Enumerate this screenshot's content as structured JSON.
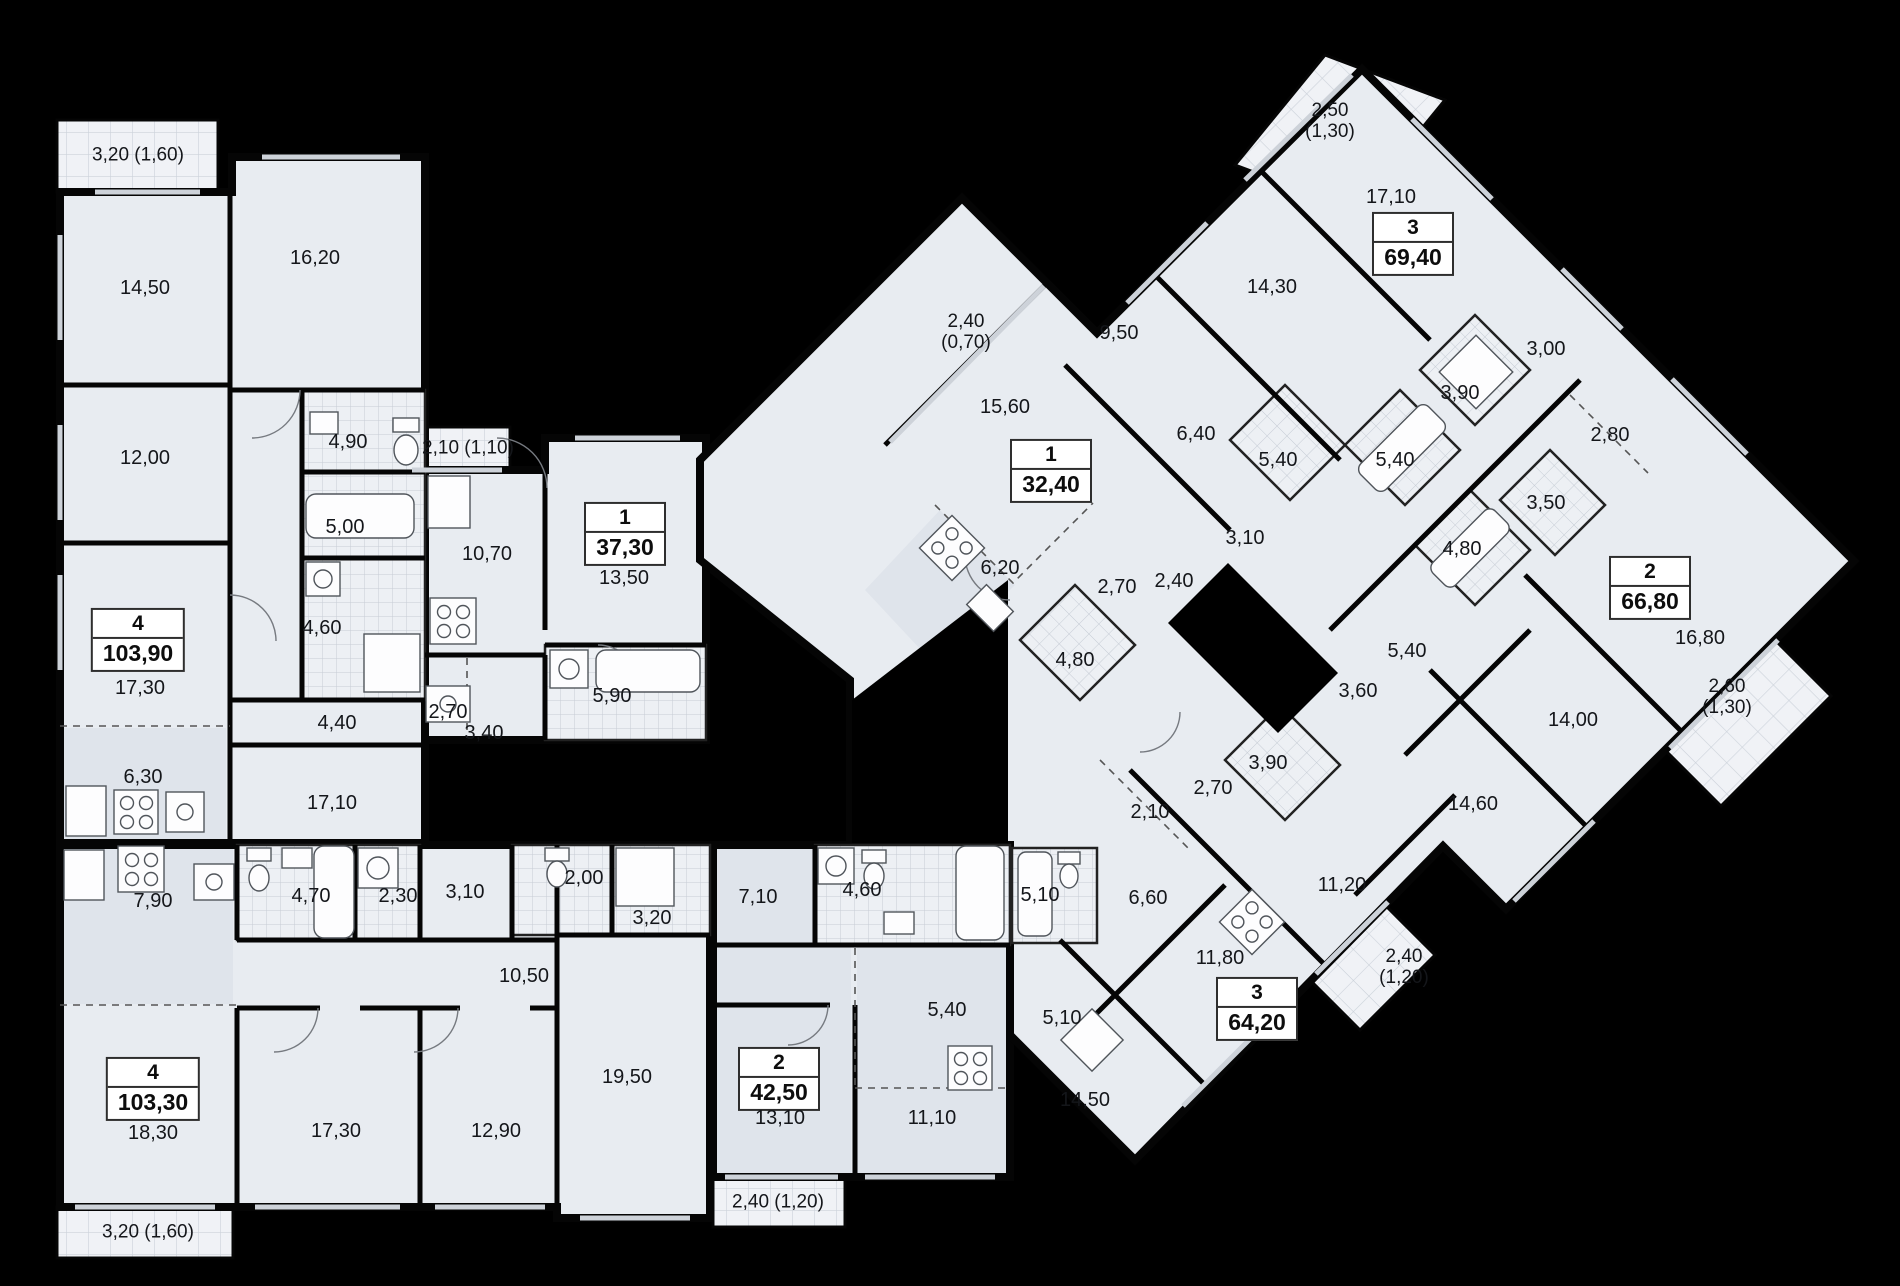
{
  "plan_type": "residential floor plan",
  "colors": {
    "background": "#000000",
    "walls": "#050505",
    "floor": "#e8ecf1",
    "floor_alt": "#dfe4eb",
    "tile_line": "#c6ccd5",
    "balcony_tile": "#f0f2f6",
    "text": "#14161a"
  },
  "apartments": [
    {
      "id": "apt-4-103-90",
      "rooms": "4",
      "area": "103,90",
      "badge": {
        "x": 138,
        "y": 640
      },
      "labels": [
        {
          "t": "14,50",
          "x": 145,
          "y": 288
        },
        {
          "t": "16,20",
          "x": 315,
          "y": 258
        },
        {
          "t": "12,00",
          "x": 145,
          "y": 458
        },
        {
          "t": "4,90",
          "x": 348,
          "y": 442
        },
        {
          "t": "5,00",
          "x": 345,
          "y": 527
        },
        {
          "t": "4,60",
          "x": 322,
          "y": 628
        },
        {
          "t": "17,30",
          "x": 140,
          "y": 688
        },
        {
          "t": "4,40",
          "x": 337,
          "y": 723
        },
        {
          "t": "6,30",
          "x": 143,
          "y": 777
        },
        {
          "t": "17,10",
          "x": 332,
          "y": 803
        }
      ],
      "balcony": {
        "lines": [
          "3,20 (1,60)"
        ],
        "x": 138,
        "y": 156
      }
    },
    {
      "id": "apt-1-37-30",
      "rooms": "1",
      "area": "37,30",
      "badge": {
        "x": 625,
        "y": 534
      },
      "labels": [
        {
          "t": "10,70",
          "x": 487,
          "y": 554
        },
        {
          "t": "13,50",
          "x": 624,
          "y": 578
        },
        {
          "t": "2,70",
          "x": 448,
          "y": 712
        },
        {
          "t": "3,40",
          "x": 484,
          "y": 733
        },
        {
          "t": "5,90",
          "x": 612,
          "y": 696
        }
      ],
      "balcony": {
        "lines": [
          "2,10 (1,10)"
        ],
        "x": 468,
        "y": 449
      }
    },
    {
      "id": "apt-1-32-40",
      "rooms": "1",
      "area": "32,40",
      "badge": {
        "x": 1051,
        "y": 471
      },
      "labels": [
        {
          "t": "15,60",
          "x": 1005,
          "y": 407
        },
        {
          "t": "6,20",
          "x": 1000,
          "y": 568
        },
        {
          "t": "2,70",
          "x": 1117,
          "y": 587
        },
        {
          "t": "2,40",
          "x": 1174,
          "y": 581
        },
        {
          "t": "4,80",
          "x": 1075,
          "y": 660
        }
      ],
      "balcony": {
        "lines": [
          "2,40",
          "(0,70)"
        ],
        "x": 966,
        "y": 333
      }
    },
    {
      "id": "apt-3-69-40",
      "rooms": "3",
      "area": "69,40",
      "badge": {
        "x": 1413,
        "y": 244
      },
      "labels": [
        {
          "t": "17,10",
          "x": 1391,
          "y": 197
        },
        {
          "t": "14,30",
          "x": 1272,
          "y": 287
        },
        {
          "t": "9,50",
          "x": 1119,
          "y": 333
        },
        {
          "t": "6,40",
          "x": 1196,
          "y": 434
        },
        {
          "t": "5,40",
          "x": 1278,
          "y": 460
        },
        {
          "t": "5,40",
          "x": 1395,
          "y": 460
        },
        {
          "t": "3,90",
          "x": 1460,
          "y": 393
        },
        {
          "t": "3,10",
          "x": 1245,
          "y": 538
        },
        {
          "t": "3,00",
          "x": 1546,
          "y": 349
        }
      ],
      "balcony": {
        "lines": [
          "2,50",
          "(1,30)"
        ],
        "x": 1330,
        "y": 122
      }
    },
    {
      "id": "apt-2-66-80",
      "rooms": "2",
      "area": "66,80",
      "badge": {
        "x": 1650,
        "y": 588
      },
      "labels": [
        {
          "t": "2,80",
          "x": 1610,
          "y": 435
        },
        {
          "t": "3,50",
          "x": 1546,
          "y": 503
        },
        {
          "t": "4,80",
          "x": 1462,
          "y": 549
        },
        {
          "t": "5,40",
          "x": 1407,
          "y": 651
        },
        {
          "t": "3,60",
          "x": 1358,
          "y": 691
        },
        {
          "t": "16,80",
          "x": 1700,
          "y": 638
        },
        {
          "t": "14,00",
          "x": 1573,
          "y": 720
        },
        {
          "t": "14,60",
          "x": 1473,
          "y": 804
        }
      ],
      "balcony": {
        "lines": [
          "2,60",
          "(1,30)"
        ],
        "x": 1727,
        "y": 698
      }
    },
    {
      "id": "apt-3-64-20",
      "rooms": "3",
      "area": "64,20",
      "badge": {
        "x": 1257,
        "y": 1009
      },
      "labels": [
        {
          "t": "3,90",
          "x": 1268,
          "y": 763
        },
        {
          "t": "2,70",
          "x": 1213,
          "y": 788
        },
        {
          "t": "2,10",
          "x": 1150,
          "y": 812
        },
        {
          "t": "5,10",
          "x": 1040,
          "y": 895
        },
        {
          "t": "6,60",
          "x": 1148,
          "y": 898
        },
        {
          "t": "11,20",
          "x": 1342,
          "y": 885
        },
        {
          "t": "11,80",
          "x": 1220,
          "y": 958
        },
        {
          "t": "5,10",
          "x": 1062,
          "y": 1018
        },
        {
          "t": "14,50",
          "x": 1085,
          "y": 1100
        }
      ],
      "balcony": {
        "lines": [
          "2,40",
          "(1,20)"
        ],
        "x": 1404,
        "y": 968
      }
    },
    {
      "id": "apt-4-103-30",
      "rooms": "4",
      "area": "103,30",
      "badge": {
        "x": 153,
        "y": 1089
      },
      "labels": [
        {
          "t": "7,90",
          "x": 153,
          "y": 901
        },
        {
          "t": "4,70",
          "x": 311,
          "y": 896
        },
        {
          "t": "2,30",
          "x": 398,
          "y": 896
        },
        {
          "t": "3,10",
          "x": 465,
          "y": 892
        },
        {
          "t": "2,00",
          "x": 584,
          "y": 878
        },
        {
          "t": "3,20",
          "x": 652,
          "y": 918
        },
        {
          "t": "10,50",
          "x": 524,
          "y": 976
        },
        {
          "t": "18,30",
          "x": 153,
          "y": 1133
        },
        {
          "t": "17,30",
          "x": 336,
          "y": 1131
        },
        {
          "t": "12,90",
          "x": 496,
          "y": 1131
        },
        {
          "t": "19,50",
          "x": 627,
          "y": 1077
        }
      ],
      "balcony": {
        "lines": [
          "3,20 (1,60)"
        ],
        "x": 148,
        "y": 1233
      }
    },
    {
      "id": "apt-2-42-50",
      "rooms": "2",
      "area": "42,50",
      "badge": {
        "x": 779,
        "y": 1079
      },
      "labels": [
        {
          "t": "7,10",
          "x": 758,
          "y": 897
        },
        {
          "t": "4,60",
          "x": 862,
          "y": 890
        },
        {
          "t": "5,40",
          "x": 947,
          "y": 1010
        },
        {
          "t": "13,10",
          "x": 780,
          "y": 1118
        },
        {
          "t": "11,10",
          "x": 932,
          "y": 1118
        }
      ],
      "balcony": {
        "lines": [
          "2,40 (1,20)"
        ],
        "x": 778,
        "y": 1203
      }
    }
  ]
}
